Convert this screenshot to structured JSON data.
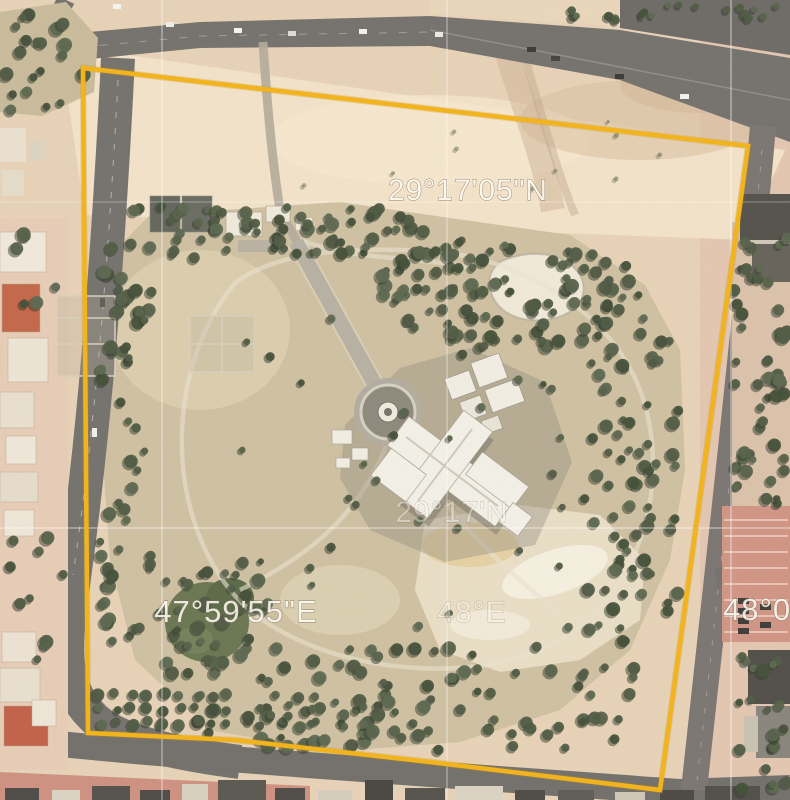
{
  "map": {
    "description": "Satellite aerial view of a walled palace compound with park, surrounded by roads, with a coordinate graticule and a yellow site-boundary polygon overlay",
    "labels": {
      "lat_top": "29°17'05\"N",
      "lat_mid": "29°17'N",
      "lon_left": "47°59'55\"E",
      "lon_mid": "48°E",
      "lon_right_clipped": "48°0"
    },
    "colors": {
      "boundary": "#f1b41f",
      "graticule": "#ffffff",
      "sand": "#e7d2b6",
      "park": "#cfc0a1",
      "road": "#75726d",
      "tree": "#4f5a42"
    }
  }
}
